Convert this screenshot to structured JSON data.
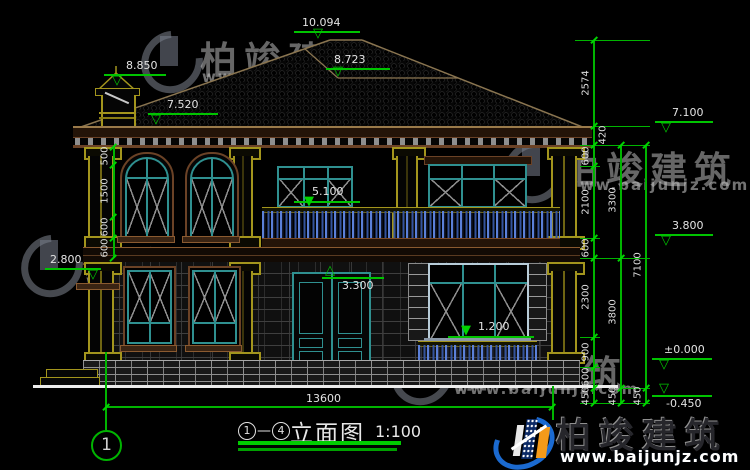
{
  "elevation_markers": {
    "ridge": "10.094",
    "chimney_top": "8.850",
    "sub_ridge": "8.723",
    "eave_top": "7.520",
    "eave_bottom_right": "7.100",
    "balcony_rail": "5.100",
    "second_floor_right": "3.800",
    "door_arch": "3.300",
    "left_ledge": "2.800",
    "window_sill": "1.200",
    "ground": "±0.000",
    "below_ground": "-0.450"
  },
  "dimensions": {
    "left_chain": [
      "500",
      "1500",
      "600",
      "600"
    ],
    "right_inner": [
      "2574",
      "420",
      "600",
      "2100",
      "600",
      "2300",
      "900",
      "600",
      "450"
    ],
    "right_middle": [
      "3300",
      "3800",
      "450"
    ],
    "right_outer": [
      "7100",
      "450"
    ],
    "overall_width": "13600"
  },
  "axis": {
    "bubble_1": "1"
  },
  "title": {
    "axis_start": "1",
    "dash": "—",
    "axis_end": "4",
    "text": "立面图",
    "scale": "1:100"
  },
  "watermark": {
    "brand": "柏竣建筑",
    "url": "www.baijunjz.com"
  },
  "logo": {
    "brand": "柏竣建筑",
    "url": "www.baijunjz.com"
  }
}
